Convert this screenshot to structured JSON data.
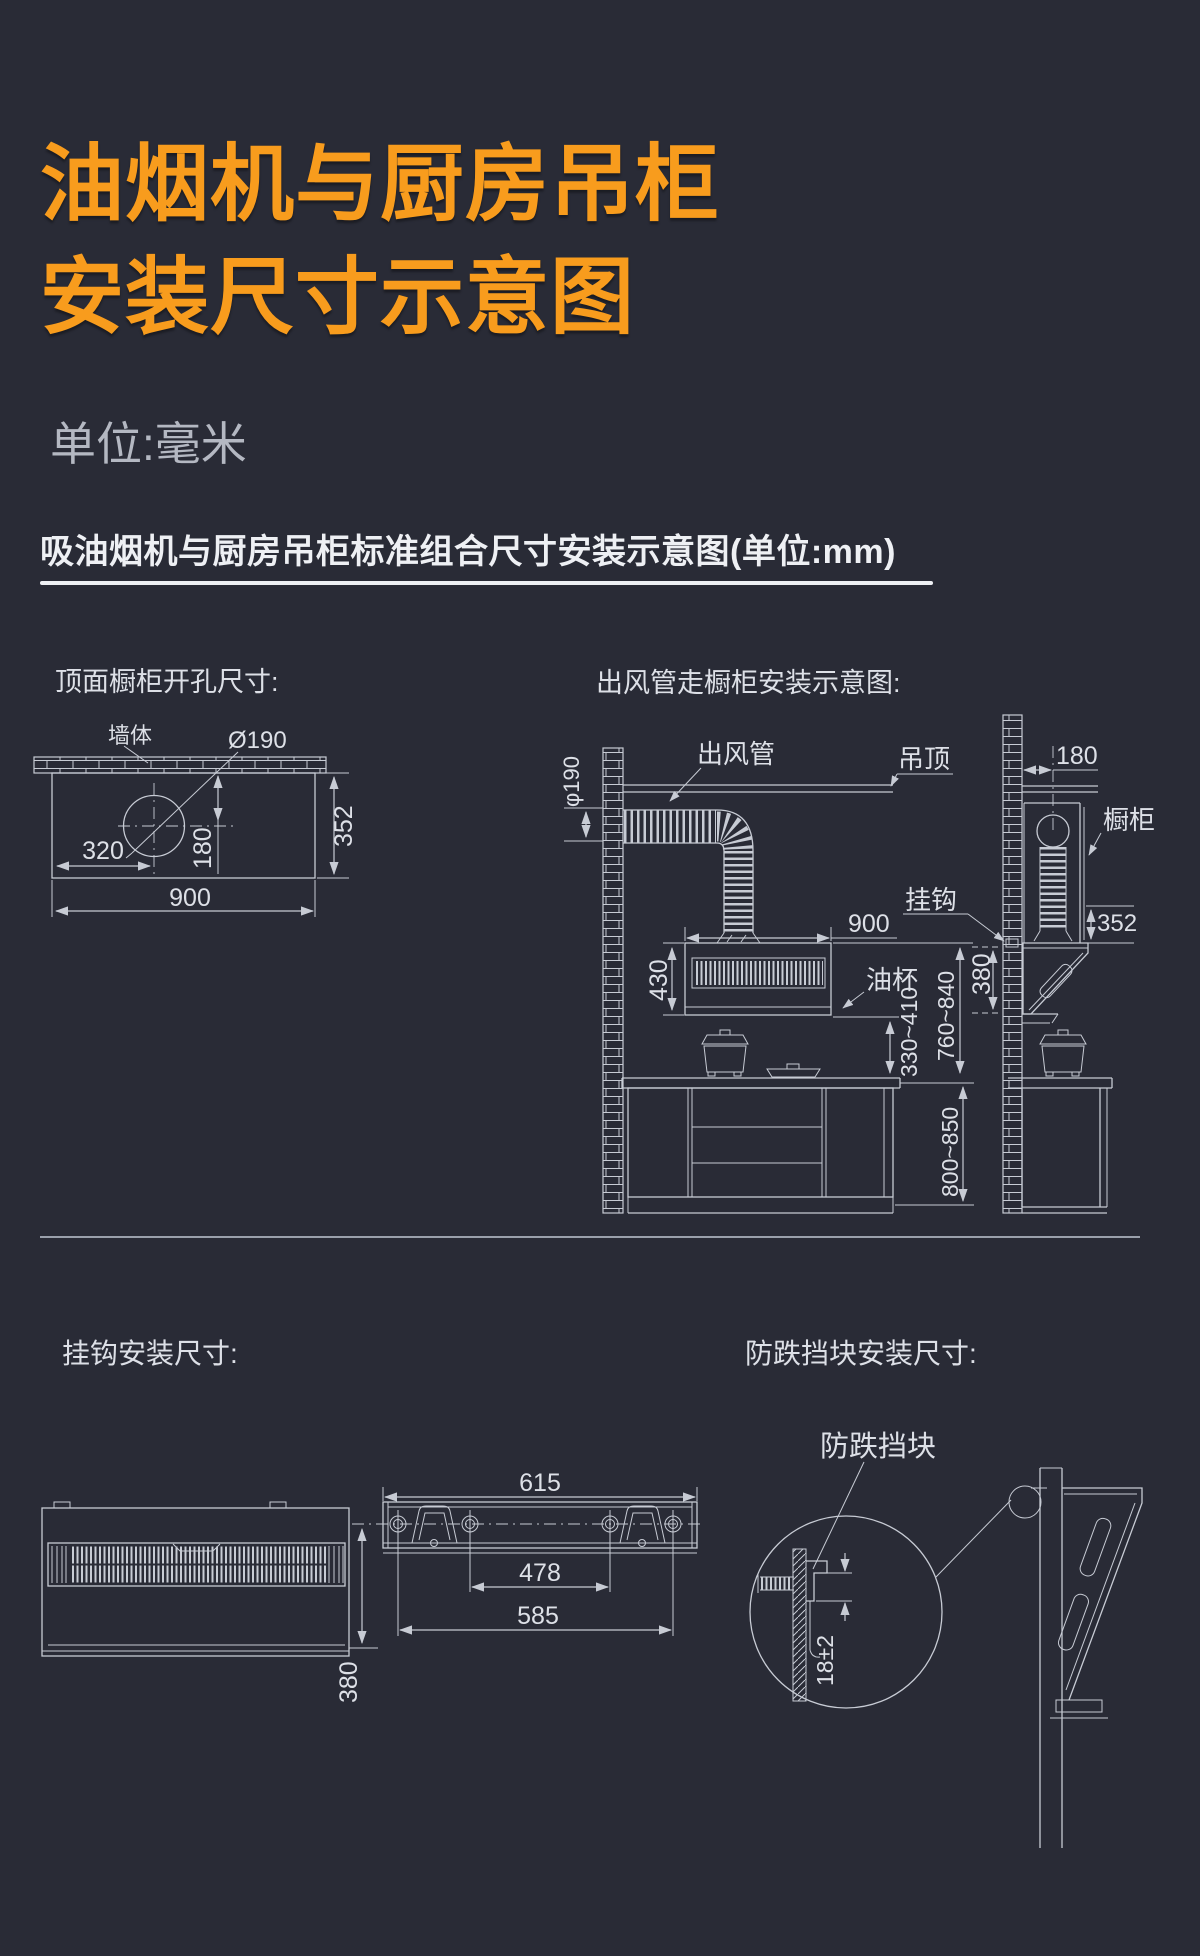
{
  "page": {
    "title_line1": "油烟机与厨房吊柜",
    "title_line2": "安装尺寸示意图",
    "unit_note": "单位:毫米",
    "section_header": "吸油烟机与厨房吊柜标准组合尺寸安装示意图(单位:mm)"
  },
  "colors": {
    "background": "#292B36",
    "accent": "#F89C1D",
    "line": "#C7CBD4",
    "text": "#DDE0E7"
  },
  "top_view": {
    "title": "顶面橱柜开孔尺寸:",
    "wall_label": "墙体",
    "hole_label": "Ø190",
    "dim_320": "320",
    "dim_180": "180",
    "dim_900": "900",
    "dim_352": "352"
  },
  "duct_view": {
    "title": "出风管走橱柜安装示意图:",
    "duct_label": "出风管",
    "ceiling_label": "吊顶",
    "dia_label": "φ190",
    "hook_label": "挂钩",
    "oilcup_label": "油杯",
    "cabinet_label": "橱柜",
    "dim_900": "900",
    "dim_430": "430",
    "dim_180": "180",
    "dim_352": "352",
    "dim_380": "380",
    "dim_330_410": "330~410",
    "dim_760_840": "760~840",
    "dim_800_850": "800~850"
  },
  "hook_view": {
    "title": "挂钩安装尺寸:",
    "dim_615": "615",
    "dim_478": "478",
    "dim_585": "585",
    "dim_380": "380"
  },
  "block_view": {
    "title": "防跌挡块安装尺寸:",
    "block_label": "防跌挡块",
    "dim_18": "18±2"
  }
}
